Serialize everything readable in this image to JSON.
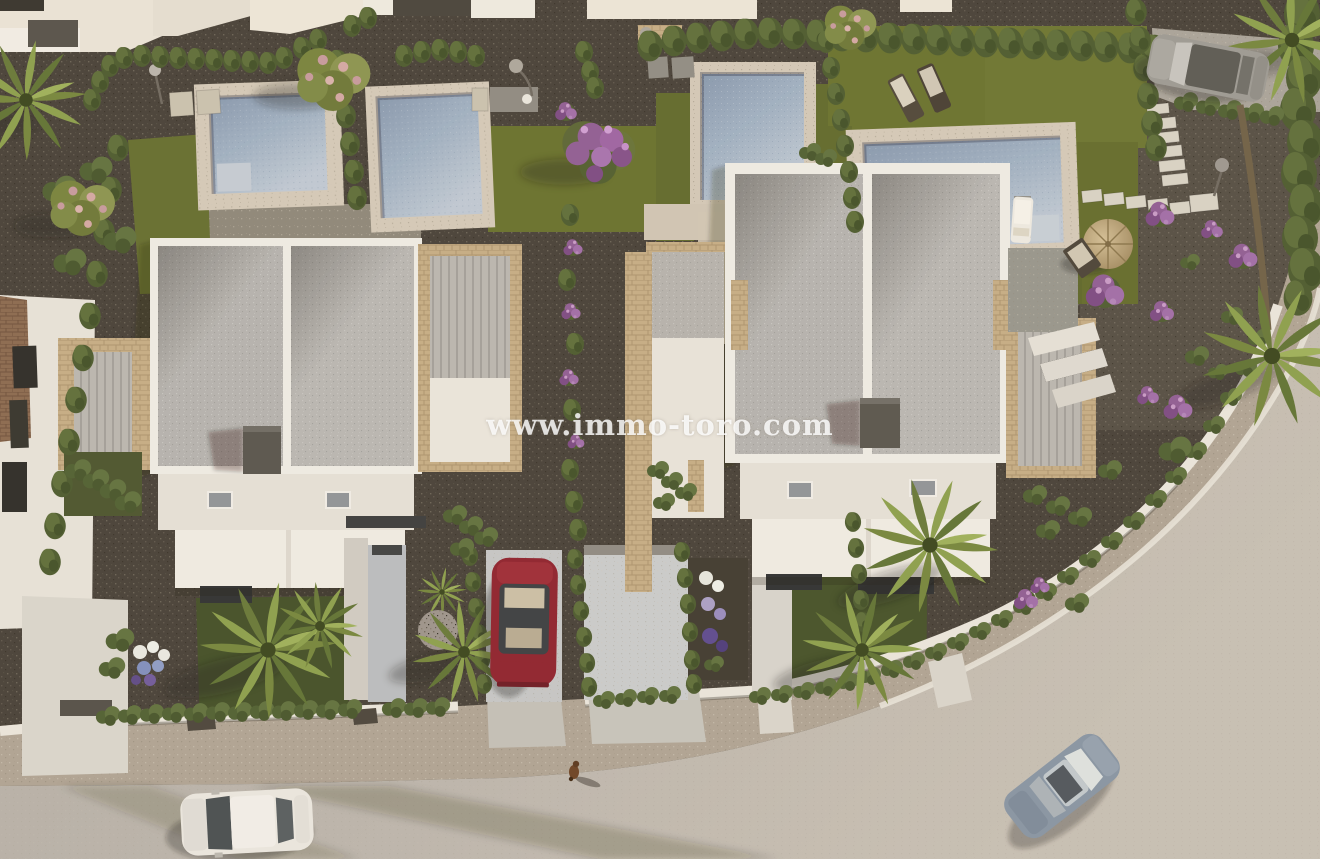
{
  "watermark": {
    "text": "www.immo-toro.com"
  },
  "palette": {
    "gravel_dark": "#46413a",
    "gravel_light": "#57514a",
    "road_asphalt": "#bab5ae",
    "sidewalk_gravel": "#b2a99b",
    "kerb_white": "#e9e6df",
    "roof_gray": "#b4b3b1",
    "wall_white": "#efede8",
    "stone_travertine": "#c4ad87",
    "pool_water": "#9db0c4",
    "pool_deck": "#d3cabb",
    "lawn_green": "#646e31",
    "hedge_green": "#55653a",
    "flower_purple": "#8f5d96",
    "flower_pink": "#c69aa0",
    "car_red": "#8e2230",
    "car_white": "#e9e7e2",
    "car_blue_gray": "#8695a6",
    "car_silver": "#9b9a96",
    "parasol_tan": "#c0ab82"
  },
  "scene": {
    "description": "Aerial 3D render of a modern white villa development: two duplex villas with travertine pergolas, four pools, lawns, gravel gardens, palms, a curved street with parked and driving cars, and a small dog on the pavement.",
    "villa_count": 2,
    "pool_count": 4,
    "car_count": 4,
    "objects": [
      "left-villa",
      "right-villa",
      "neighbor-house",
      "pool-1",
      "pool-2",
      "pool-3",
      "pool-4",
      "red-car",
      "white-car",
      "blue-car",
      "silver-suv",
      "parasol",
      "sun-loungers",
      "stepping-stones",
      "street",
      "dog"
    ]
  }
}
